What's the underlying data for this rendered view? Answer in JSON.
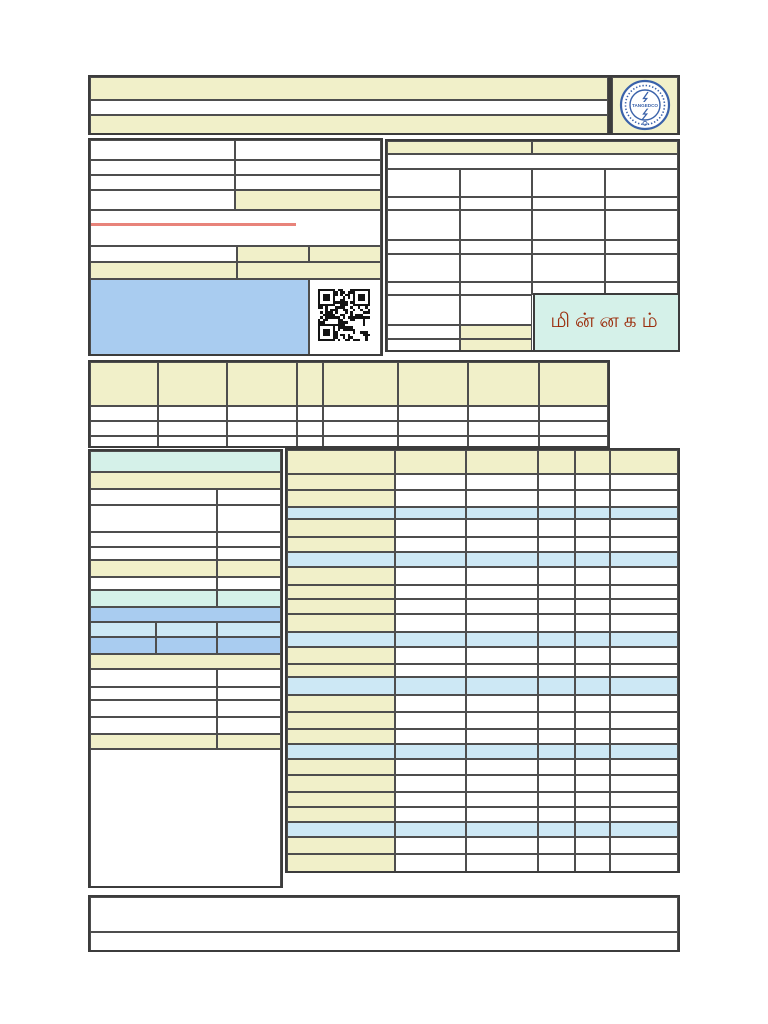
{
  "document": {
    "type": "electricity-bill-template",
    "page_background": "#ffffff"
  },
  "colors": {
    "white": "#ffffff",
    "cream": "#f1f0c9",
    "blue": "#a9ccf0",
    "lightblue": "#cde8f5",
    "teal": "#d5f1e9",
    "border": "#3c3c3c",
    "accent_line": "#e8837a",
    "tamil_text": "#9b2d0c",
    "logo_blue": "#3a62aa",
    "qr_dark": "#141414"
  },
  "logo": {
    "icon": "tangedco-seal-icon",
    "text": "TANGEDCO"
  },
  "labels": {
    "minnagam": "மின்னகம்"
  },
  "qr": {
    "icon": "qr-code-icon",
    "modules": 21,
    "size": 52
  },
  "row_templates": {
    "bl2w": [
      "white:130",
      "white:65"
    ],
    "bl2c": [
      "cream:130",
      "cream:65"
    ],
    "bl2t": [
      "teal:130",
      "teal:65"
    ],
    "bl3l": [
      "lightblue:67",
      "lightblue:63",
      "lightblue:65"
    ],
    "bl3b": [
      "blue:67",
      "blue:63",
      "blue:65"
    ],
    "mid_h": [
      "cream:69",
      "cream:69",
      "cream:71",
      "cream:26",
      "cream:75",
      "cream:71",
      "cream:71",
      "cream:70"
    ],
    "mid_w": [
      "white:69",
      "white:69",
      "white:71",
      "white:26",
      "white:75",
      "white:71",
      "white:71",
      "white:70"
    ],
    "rp4w": [
      "white:74",
      "white:73",
      "white:74",
      "white:74"
    ],
    "brh": [
      "cream:109",
      "cream:72",
      "cream:73",
      "cream:37",
      "cream:35",
      "cream:69"
    ],
    "brl": [
      "cream:109",
      "white:72",
      "white:73",
      "white:37",
      "white:35",
      "white:69"
    ],
    "brb": [
      "lightblue:109",
      "lightblue:72",
      "lightblue:73",
      "lightblue:37",
      "lightblue:35",
      "lightblue:69"
    ]
  },
  "grids": [
    {
      "name": "header-rows",
      "x": 88,
      "y": 75,
      "w": 522,
      "h": 60,
      "rows": [
        {
          "h": 23,
          "c": [
            "cream:522"
          ]
        },
        {
          "h": 15,
          "c": [
            "white:522"
          ]
        },
        {
          "h": 22,
          "c": [
            "cream:522"
          ]
        }
      ]
    },
    {
      "name": "logo-cell",
      "x": 610,
      "y": 75,
      "w": 70,
      "h": 60,
      "rows": [
        {
          "h": 60,
          "c": [
            "cream:70"
          ]
        }
      ]
    },
    {
      "name": "customer-info-panel",
      "x": 88,
      "y": 138,
      "w": 295,
      "h": 218,
      "rows": [
        {
          "h": 20,
          "c": [
            "white:147",
            "white:148"
          ]
        },
        {
          "h": 15,
          "c": [
            "white:147",
            "white:148"
          ]
        },
        {
          "h": 15,
          "c": [
            "white:147",
            "white:148"
          ]
        },
        {
          "h": 20,
          "c": [
            "white:147",
            "cream:148"
          ]
        },
        {
          "h": 36,
          "c": [
            "white:295"
          ]
        },
        {
          "h": 16,
          "c": [
            "white:149",
            "cream:73",
            "cream:73"
          ]
        },
        {
          "h": 17,
          "c": [
            "cream:149",
            "cream:146"
          ]
        },
        {
          "h": 79,
          "c": [
            "blue:222",
            "white:73"
          ]
        }
      ]
    },
    {
      "name": "billing-info-panel",
      "x": 385,
      "y": 139,
      "w": 295,
      "h": 213,
      "rows": [
        {
          "h": 13,
          "c": [
            "cream:147",
            "cream:148"
          ]
        },
        {
          "h": 15,
          "c": [
            "white:295"
          ]
        },
        {
          "h": 28,
          "t": "rp4w"
        },
        {
          "h": 13,
          "t": "rp4w"
        },
        {
          "h": 30,
          "t": "rp4w"
        },
        {
          "h": 14,
          "t": "rp4w"
        },
        {
          "h": 28,
          "t": "rp4w"
        },
        {
          "h": 13,
          "t": "rp4w"
        },
        {
          "h": 30,
          "c": [
            "white:74",
            "white:73",
            "none:148"
          ]
        },
        {
          "h": 14,
          "c": [
            "white:74",
            "cream:73",
            "none:148"
          ]
        },
        {
          "h": 15,
          "c": [
            "white:74",
            "cream:73",
            "none:148"
          ]
        }
      ]
    },
    {
      "name": "consumption-table",
      "x": 88,
      "y": 360,
      "w": 522,
      "h": 88,
      "rows": [
        {
          "h": 44,
          "t": "mid_h"
        },
        {
          "h": 15,
          "t": "mid_w"
        },
        {
          "h": 15,
          "t": "mid_w"
        },
        {
          "h": 14,
          "t": "mid_w"
        }
      ]
    },
    {
      "name": "reading-details-panel",
      "x": 88,
      "y": 449,
      "w": 195,
      "h": 439,
      "rows": [
        {
          "h": 21,
          "c": [
            "teal:195"
          ]
        },
        {
          "h": 17,
          "c": [
            "cream:195"
          ]
        },
        {
          "h": 16,
          "t": "bl2w"
        },
        {
          "h": 27,
          "t": "bl2w"
        },
        {
          "h": 15,
          "t": "bl2w"
        },
        {
          "h": 13,
          "t": "bl2w"
        },
        {
          "h": 17,
          "t": "bl2c"
        },
        {
          "h": 13,
          "t": "bl2w"
        },
        {
          "h": 17,
          "t": "bl2t"
        },
        {
          "h": 15,
          "c": [
            "blue:195"
          ]
        },
        {
          "h": 15,
          "t": "bl3l"
        },
        {
          "h": 17,
          "t": "bl3b"
        },
        {
          "h": 15,
          "c": [
            "cream:195"
          ]
        },
        {
          "h": 18,
          "t": "bl2w"
        },
        {
          "h": 13,
          "t": "bl2w"
        },
        {
          "h": 17,
          "t": "bl2w"
        },
        {
          "h": 17,
          "t": "bl2w"
        },
        {
          "h": 15,
          "t": "bl2c"
        },
        {
          "h": 141,
          "c": [
            "white:195"
          ]
        }
      ]
    },
    {
      "name": "charges-table",
      "x": 285,
      "y": 448,
      "w": 395,
      "h": 425,
      "rows": [
        {
          "h": 24,
          "t": "brh"
        },
        {
          "h": 16,
          "t": "brl"
        },
        {
          "h": 17,
          "t": "brl"
        },
        {
          "h": 12,
          "t": "brb"
        },
        {
          "h": 18,
          "t": "brl"
        },
        {
          "h": 15,
          "t": "brl"
        },
        {
          "h": 15,
          "t": "brb"
        },
        {
          "h": 18,
          "t": "brl"
        },
        {
          "h": 14,
          "t": "brl"
        },
        {
          "h": 15,
          "t": "brl"
        },
        {
          "h": 18,
          "t": "brl"
        },
        {
          "h": 15,
          "t": "brb"
        },
        {
          "h": 17,
          "t": "brl"
        },
        {
          "h": 13,
          "t": "brl"
        },
        {
          "h": 18,
          "t": "brb"
        },
        {
          "h": 17,
          "t": "brl"
        },
        {
          "h": 17,
          "t": "brl"
        },
        {
          "h": 15,
          "t": "brl"
        },
        {
          "h": 15,
          "t": "brb"
        },
        {
          "h": 16,
          "t": "brl"
        },
        {
          "h": 17,
          "t": "brl"
        },
        {
          "h": 15,
          "t": "brl"
        },
        {
          "h": 15,
          "t": "brl"
        },
        {
          "h": 15,
          "t": "brb"
        },
        {
          "h": 17,
          "t": "brl"
        },
        {
          "h": 21,
          "t": "brl"
        }
      ]
    },
    {
      "name": "footer-rows",
      "x": 88,
      "y": 895,
      "w": 592,
      "h": 57,
      "rows": [
        {
          "h": 35,
          "c": [
            "white:592"
          ]
        },
        {
          "h": 22,
          "c": [
            "white:592"
          ]
        }
      ]
    }
  ]
}
